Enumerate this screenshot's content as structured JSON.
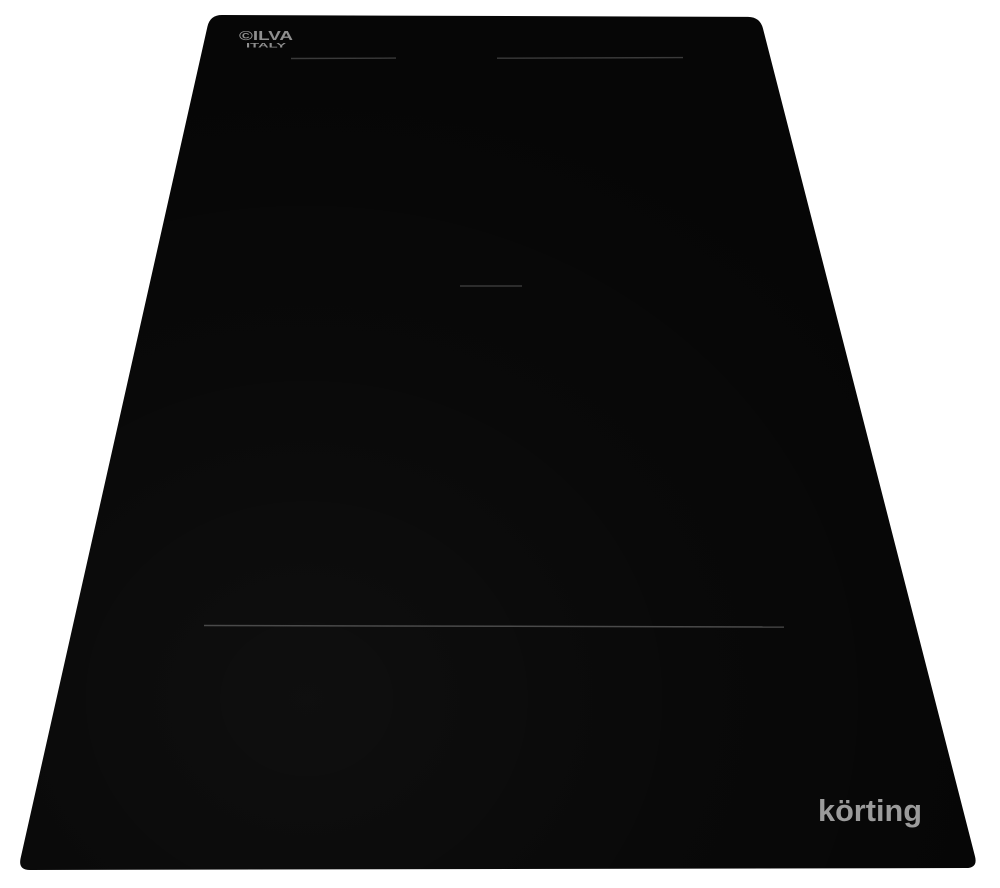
{
  "colors": {
    "background": "#ffffff",
    "surface": "#060606",
    "zone_line_top": "#3a3a3a",
    "zone_line_mid": "#2c2c2c",
    "zone_line_bottom": "#4a4a4a",
    "glass_logo": "#8f8f8f",
    "brand_logo": "#9b9b9b"
  },
  "glass_logo": {
    "line1": "©ILVA",
    "line2": "ITALY"
  },
  "brand_logo": {
    "text": "körting"
  }
}
